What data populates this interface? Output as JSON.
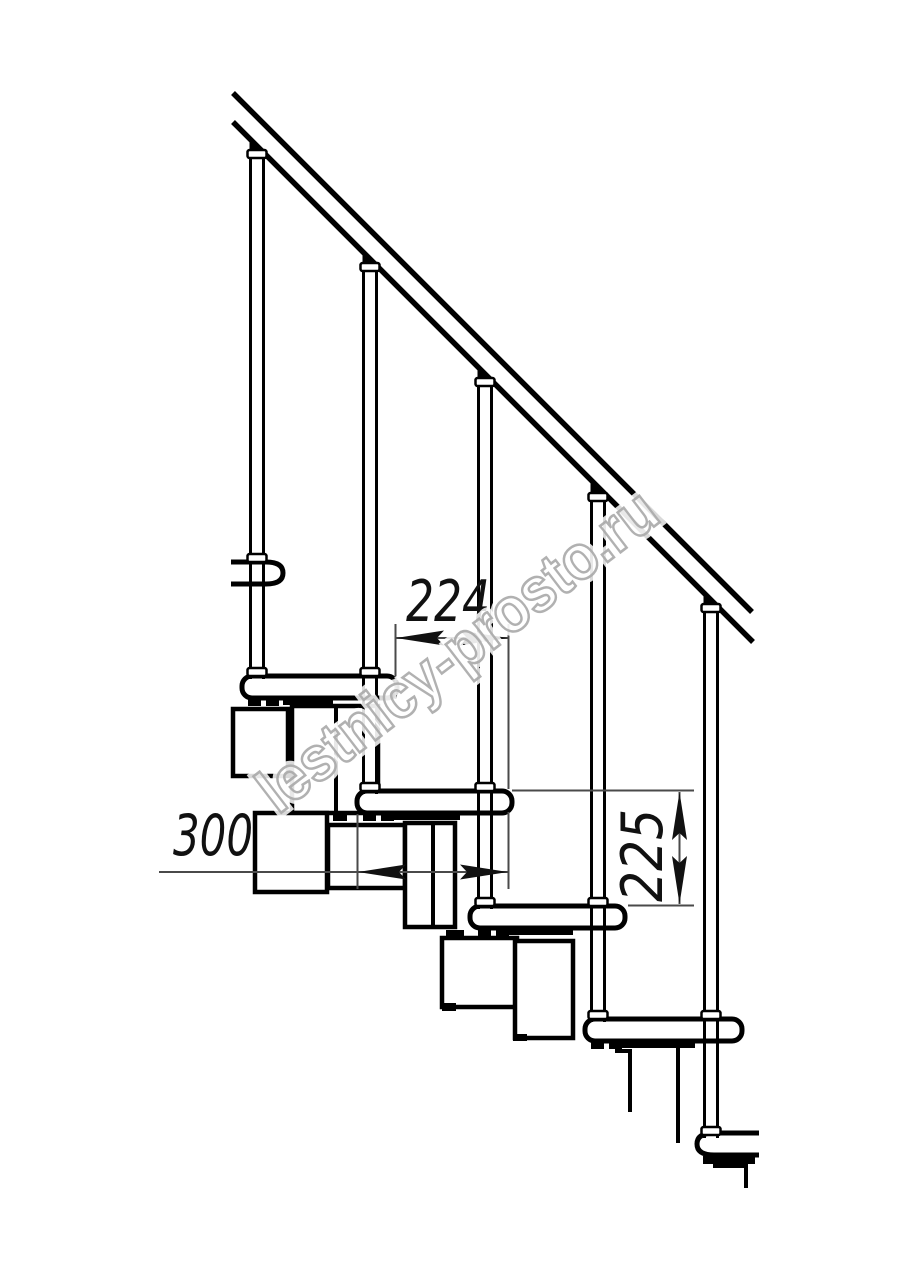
{
  "page": {
    "background": "#ffffff"
  },
  "drawing": {
    "subject": "Modular staircase side elevation (technical line drawing)",
    "line_color": "#000000",
    "dimension_line_color": "#4a4a4a",
    "watermark": {
      "text": "lestnicy-prosto.ru",
      "color": "#a8a8a8"
    },
    "dimensions": {
      "tread_pitch": {
        "value": "224",
        "orientation": "horizontal"
      },
      "step_depth": {
        "value": "300",
        "orientation": "horizontal"
      },
      "riser_height": {
        "value": "225",
        "orientation": "vertical"
      }
    },
    "structure": {
      "balusters": 5,
      "treads_visible": 6,
      "handrail": "diagonal handrail drawn as two parallel lines",
      "modules": "zigzag chain of rectangular support modules under the treads"
    }
  }
}
